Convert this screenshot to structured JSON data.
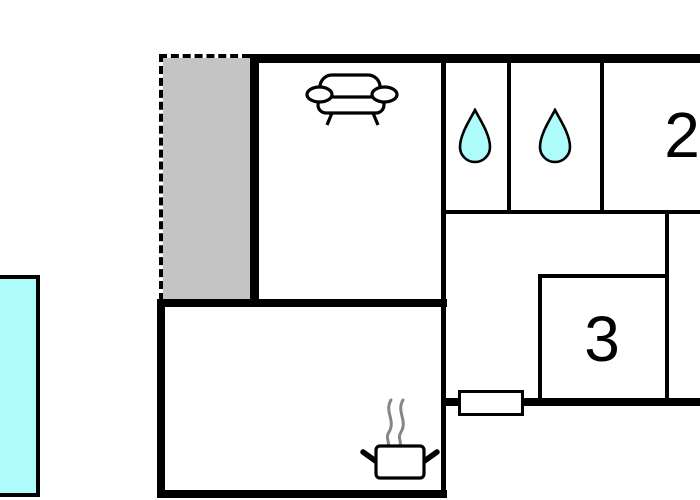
{
  "floor_plan": {
    "kind": "holiday-home floor plan",
    "rooms": {
      "living_room": {
        "name": "living room",
        "icon": "sofa-icon",
        "label": ""
      },
      "bathroom_1": {
        "name": "bathroom 1",
        "icon": "water-drop-icon",
        "label": ""
      },
      "bathroom_2": {
        "name": "bathroom 2",
        "icon": "water-drop-icon",
        "label": ""
      },
      "bedroom_2": {
        "name": "bedroom 2",
        "label": "2"
      },
      "bedroom_3": {
        "name": "bedroom 3",
        "label": "3"
      },
      "kitchen": {
        "name": "kitchen",
        "icon": "cooking-pot-icon",
        "label": ""
      },
      "hallway": {
        "name": "hallway",
        "label": ""
      },
      "terrace": {
        "name": "terrace",
        "style": "gray area with dashed outline",
        "label": ""
      },
      "pool": {
        "name": "pool",
        "style": "water area, cut off at left edge",
        "label": ""
      }
    },
    "features": {
      "door_window": "white rectangle on bottom wall of hallway",
      "dashed_outline": "terrace left and top edges",
      "cut_off_edges": "plan continues past right image edge"
    },
    "colors": {
      "wall": "#000000",
      "background": "#FFFFFF",
      "terrace_fill": "#C4C4C4",
      "water_fill": "#AEFBFB",
      "steam": "#868686"
    }
  }
}
